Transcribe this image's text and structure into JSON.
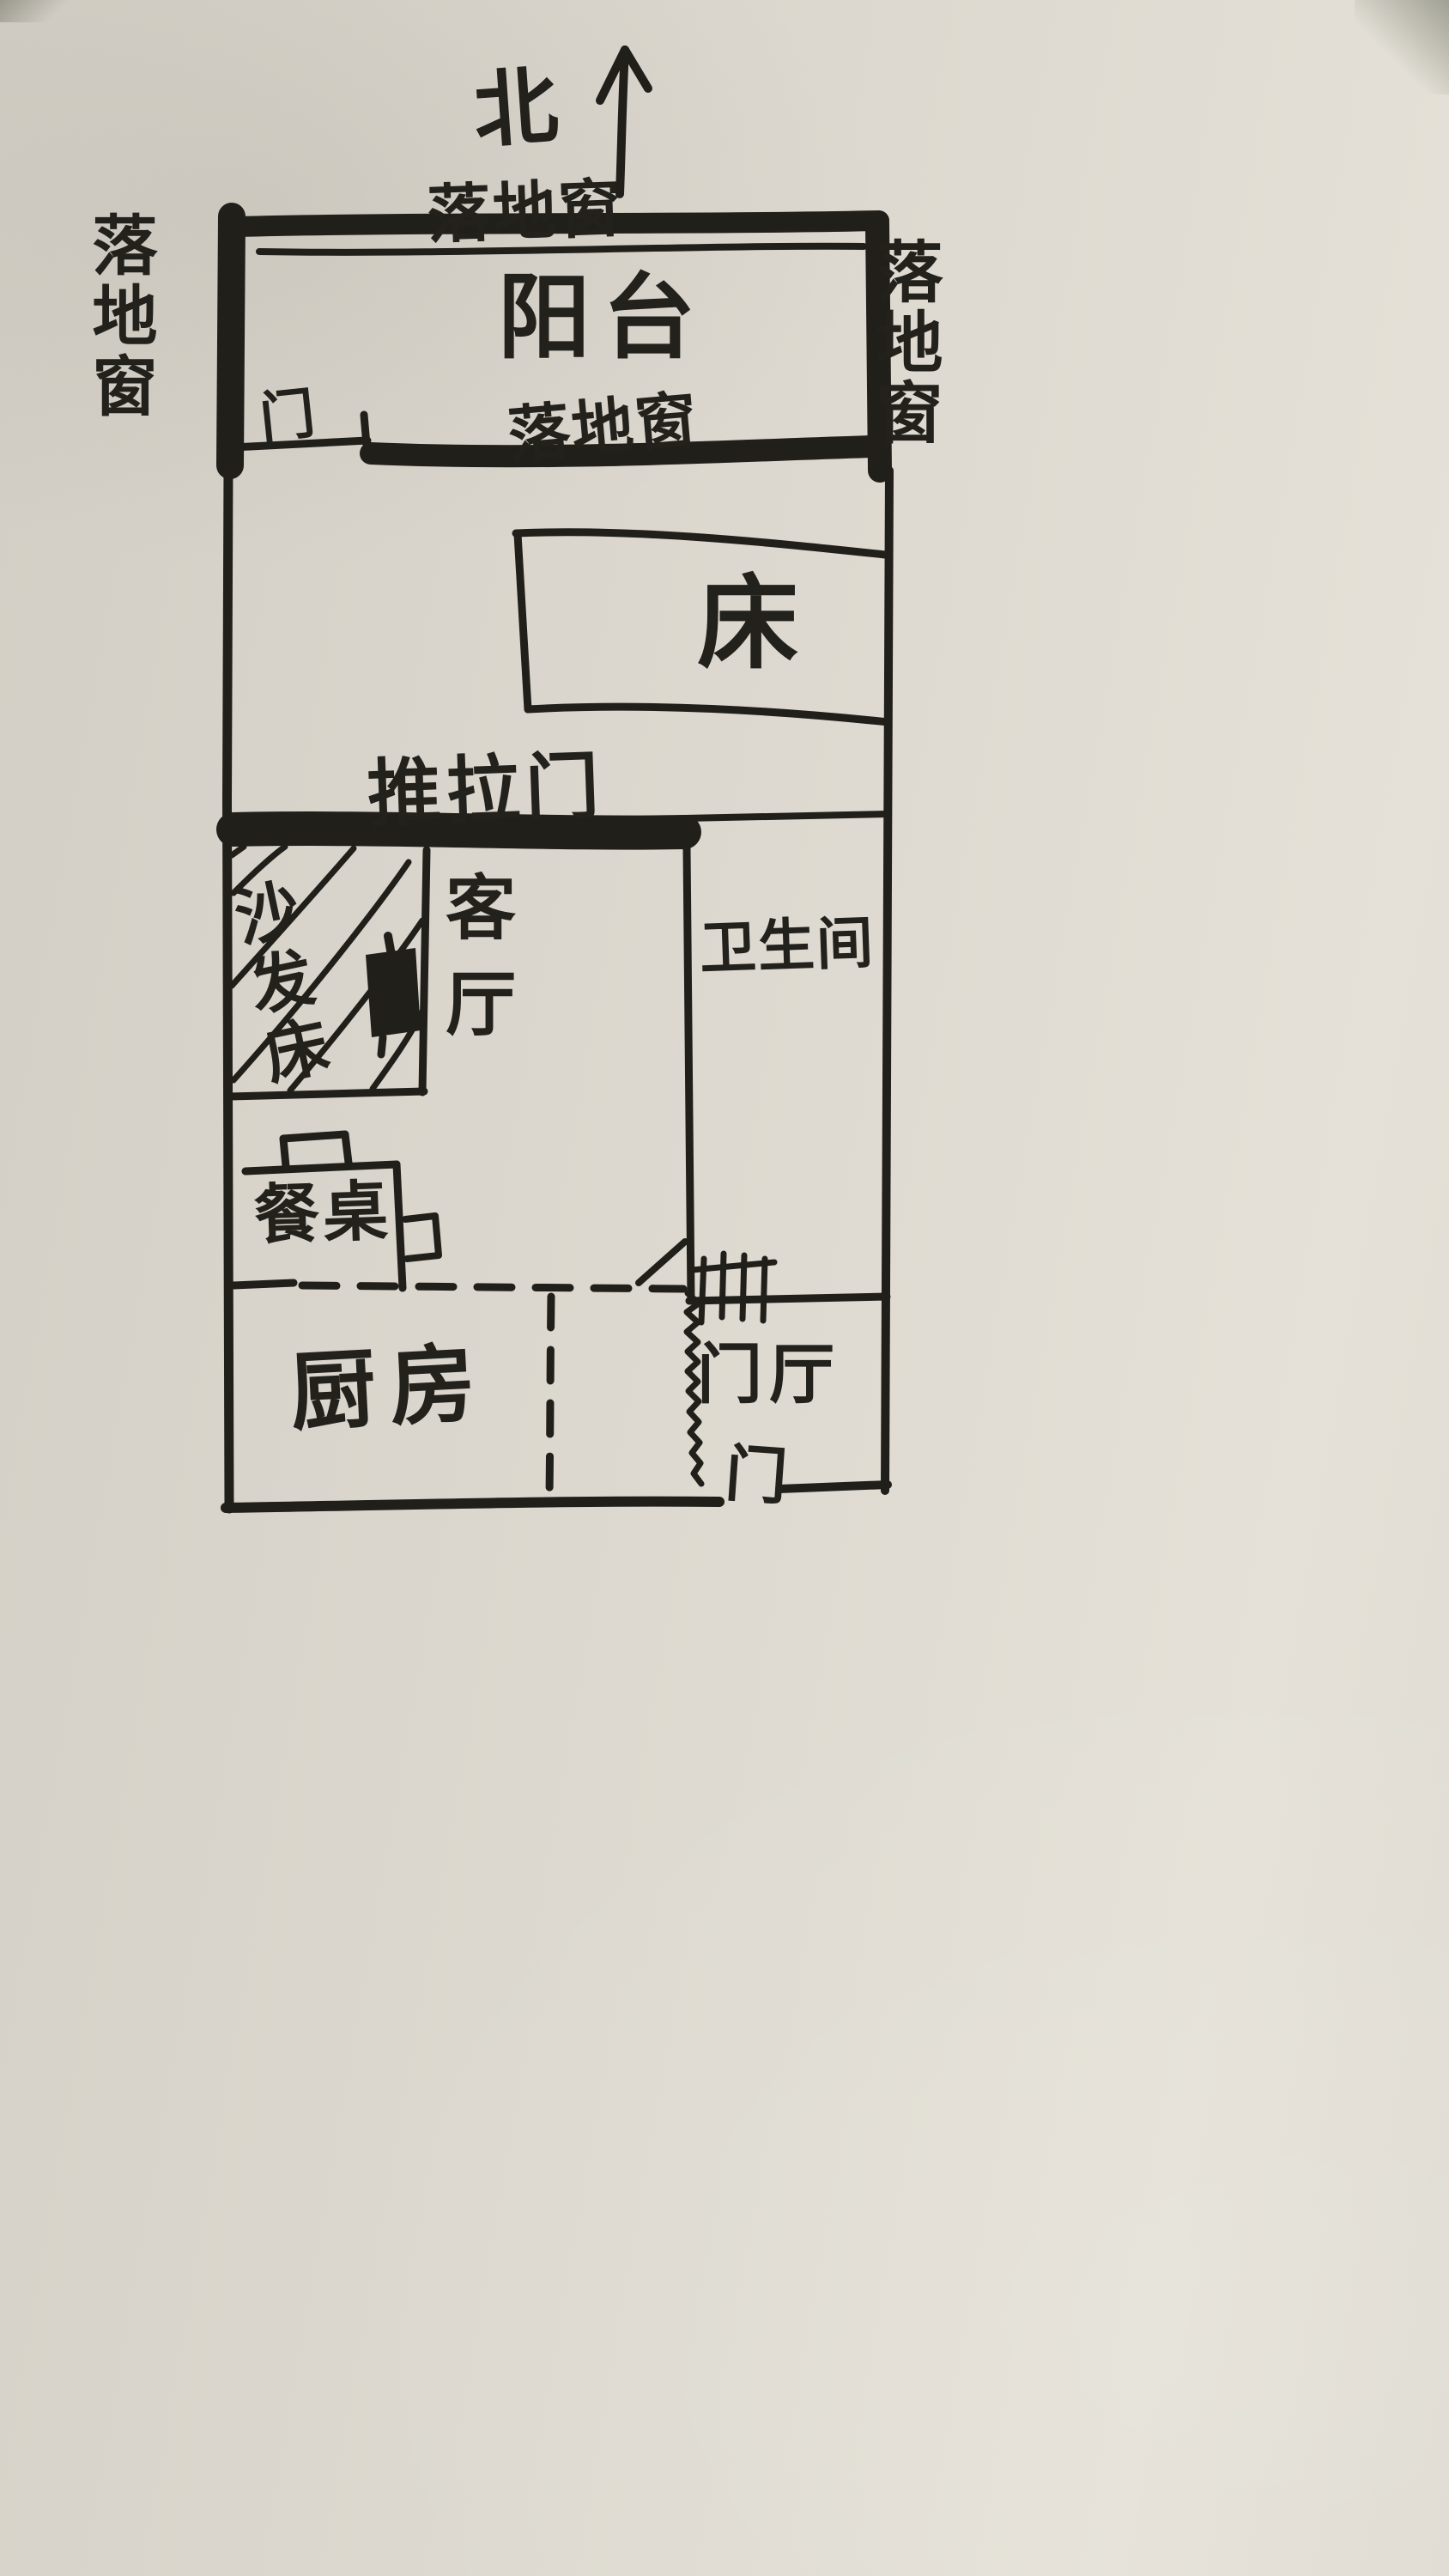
{
  "compass": {
    "north": "北"
  },
  "balcony": {
    "label": "阳台",
    "door": "门",
    "window_top": "落地窗",
    "window_left": "落地窗",
    "window_right": "落地窗",
    "window_bottom": "落地窗"
  },
  "bedroom": {
    "bed": "床"
  },
  "partition": {
    "sliding_door": "推拉门"
  },
  "living_room": {
    "label": "客厅",
    "sofa_bed": "沙发床",
    "dining_table": "餐桌"
  },
  "bathroom": {
    "label": "卫生间"
  },
  "kitchen": {
    "label": "厨房"
  },
  "entry": {
    "label": "门厅",
    "door": "门"
  },
  "colors": {
    "ink": "#23211c",
    "paper": "#dcd8cf"
  }
}
